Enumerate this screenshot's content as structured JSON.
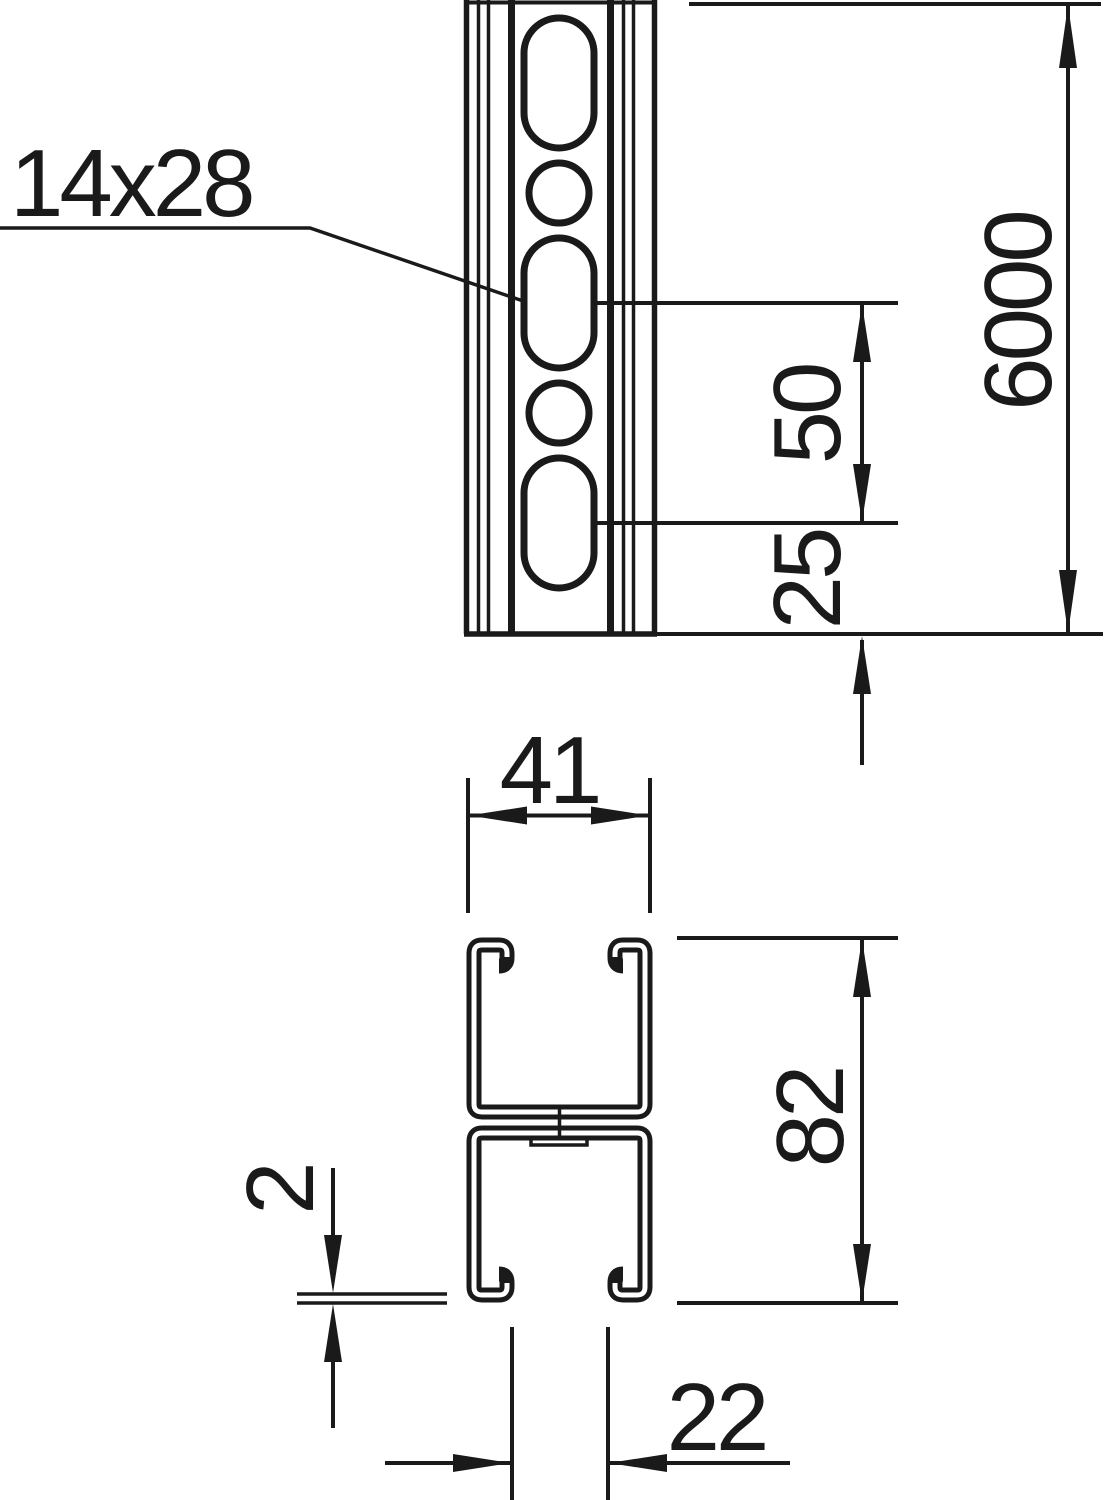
{
  "drawing": {
    "description": "Technical drawing of a perforated profile mounting rail: front view with slotted hole pattern and cross-section of double C-channel welded back-to-back",
    "colors": {
      "line": "#1a1a1a",
      "background": "#ffffff"
    },
    "front_view": {
      "labels": {
        "slot_size": "14x28",
        "length": "6000",
        "slot_pitch": "50",
        "end_distance": "25"
      }
    },
    "section_view": {
      "labels": {
        "width": "41",
        "height": "82",
        "thickness": "2",
        "opening": "22"
      }
    }
  }
}
